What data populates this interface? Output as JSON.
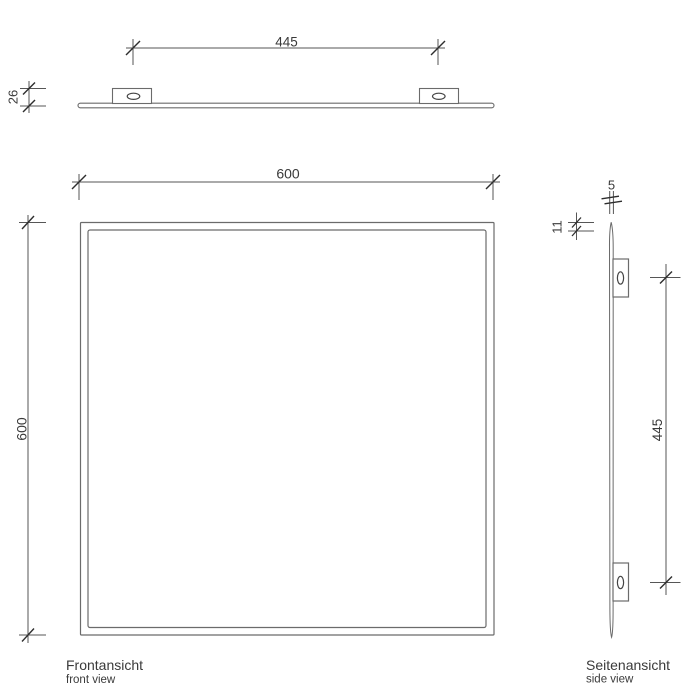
{
  "drawing": {
    "type": "technical-drawing-mirror",
    "colors": {
      "geometry_line": "#6b6b6b",
      "dim_line": "#565656",
      "tick": "#2e2e2e",
      "text": "#3a3a3a",
      "fill": "#ffffff"
    },
    "views": {
      "top": {
        "bracket_spacing_mm": "445",
        "depth_mm": "26"
      },
      "front": {
        "width_mm": "600",
        "height_mm": "600",
        "title": "Frontansicht",
        "subtitle": "front view"
      },
      "side": {
        "thickness_mm": "5",
        "offset_mm": "11",
        "bracket_spacing_mm": "445",
        "title": "Seitenansicht",
        "subtitle": "side view"
      }
    }
  }
}
